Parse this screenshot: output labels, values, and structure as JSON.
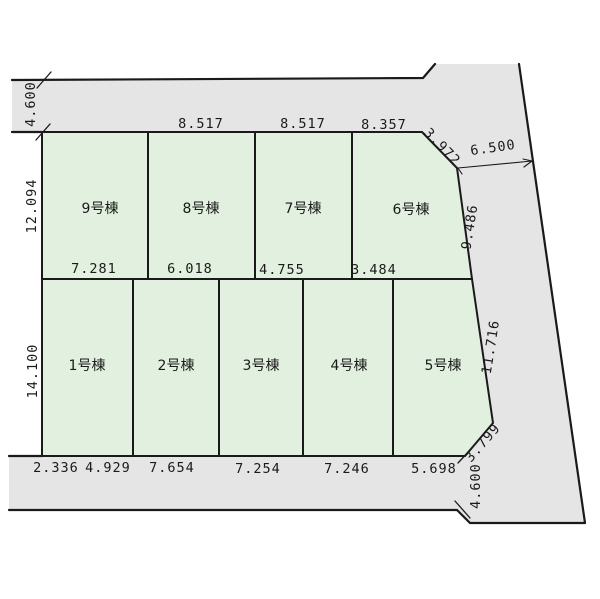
{
  "canvas": {
    "background": "#ffffff"
  },
  "colors": {
    "road_fill": "#e5e5e5",
    "plot_fill": "#e2f0df",
    "line": "#1a1a1a",
    "text": "#1a1a1a"
  },
  "plots": {
    "top_row": [
      "9号棟",
      "8号棟",
      "7号棟",
      "6号棟"
    ],
    "bottom_row": [
      "1号棟",
      "2号棟",
      "3号棟",
      "4号棟",
      "5号棟"
    ]
  },
  "dimensions": {
    "top_road_width": "4.600",
    "upper_row_depth": "12.094",
    "lower_row_depth": "14.100",
    "top_widths": [
      "8.517",
      "8.517",
      "8.357"
    ],
    "top_right_chamfer": "3.972",
    "right_road_width": "6.500",
    "right_upper_edge": "9.486",
    "right_lower_edge": "11.716",
    "bottom_right_chamfer": "3.799",
    "bottom_right_road_width": "4.600",
    "middle_widths": [
      "7.281",
      "6.018",
      "4.755",
      "3.484"
    ],
    "bottom_widths": [
      "2.336",
      "4.929",
      "7.654",
      "7.254",
      "7.246",
      "5.698"
    ]
  }
}
